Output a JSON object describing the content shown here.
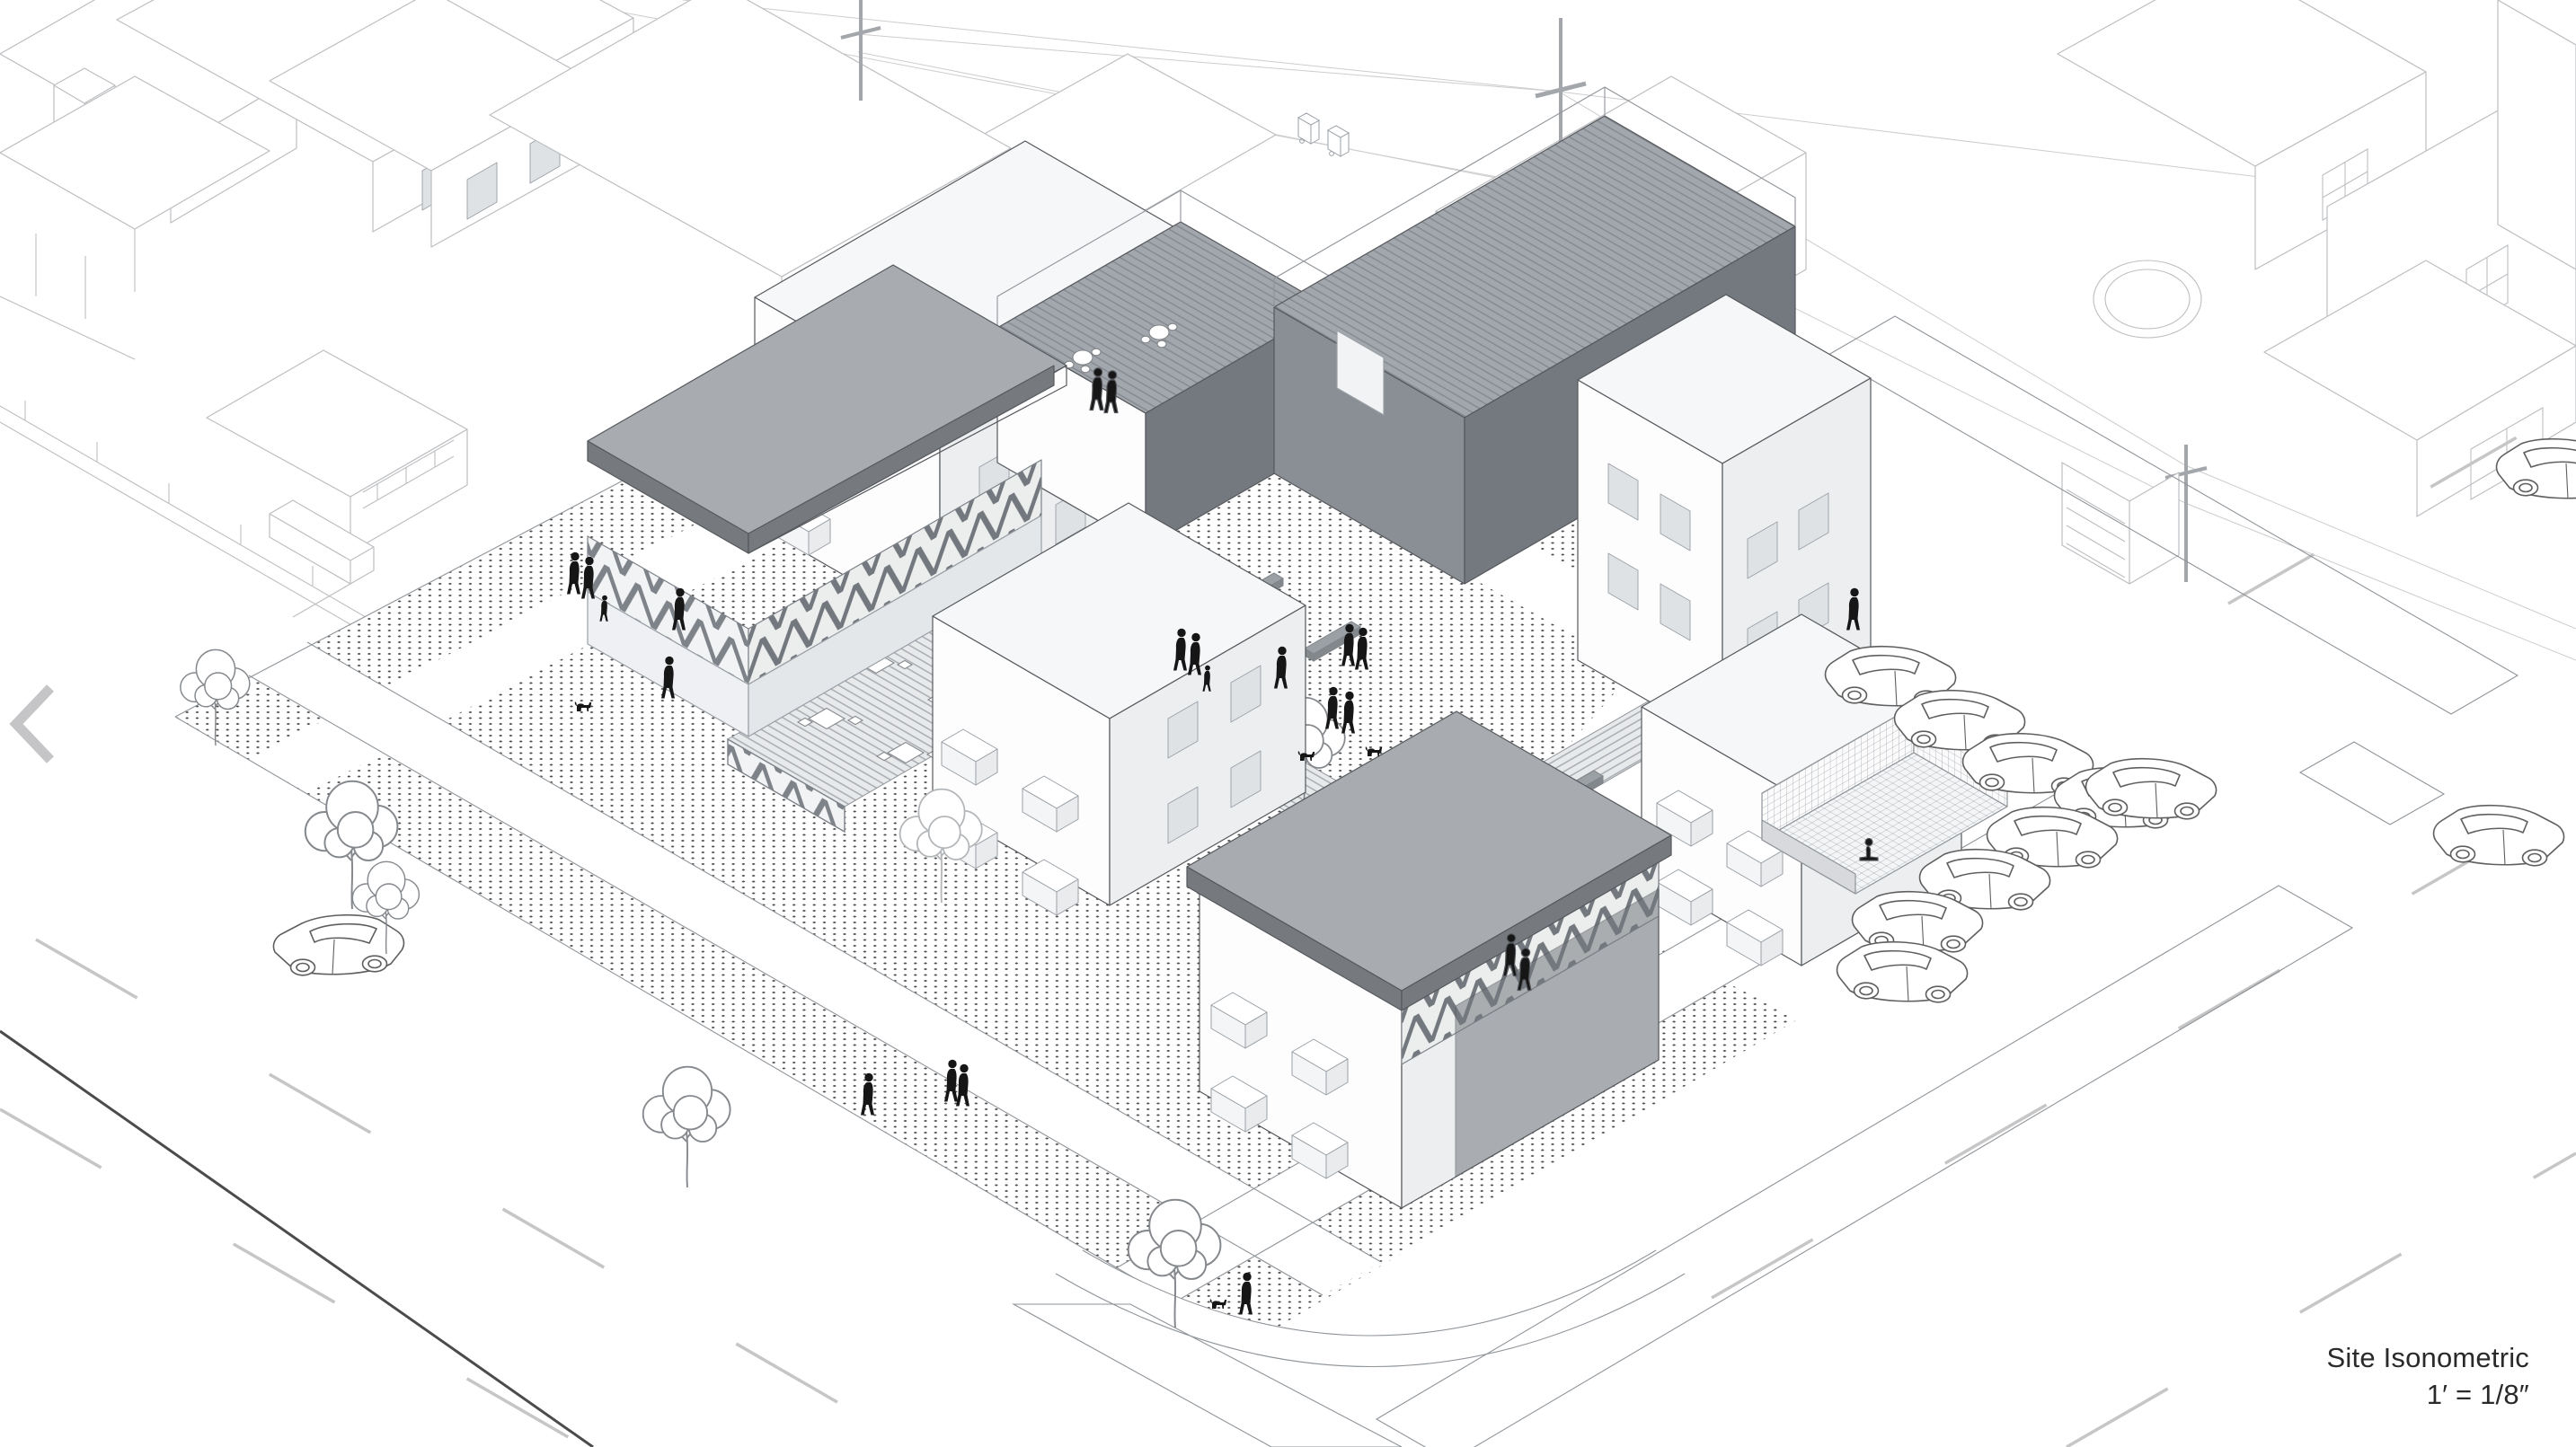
{
  "caption": {
    "title": "Site Isonometric",
    "scale_label": "1′ = 1/8″"
  },
  "navigation": {
    "previous_icon": "chevron-left"
  },
  "colors": {
    "background": "#ffffff",
    "ink": "#2a2a2a",
    "context_line": "#bcbec1",
    "detail_line": "#55585c",
    "roof_gray": "#a8abb0",
    "roof_dark_edge": "#76797d",
    "wall_dark": "#8a8f95",
    "wall_darker": "#74797f",
    "deck_light": "#e7e9eb",
    "deck_line": "#a7acb1",
    "deck_dark": "#a2a7ad",
    "deck_dark_line": "#858a90",
    "figure_black": "#161616",
    "stipple_dot": "#4e4e4e",
    "chevron_gray": "#c5c5c7",
    "edge_line": "#8f9499"
  }
}
